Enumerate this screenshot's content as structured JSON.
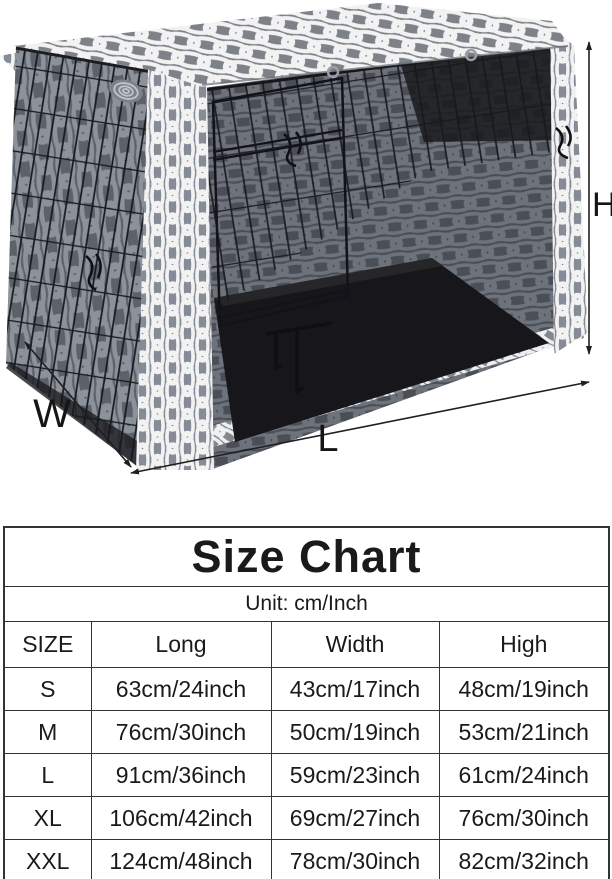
{
  "figure": {
    "dimension_labels": {
      "height": "H",
      "width": "W",
      "length": "L"
    },
    "colors": {
      "cover_gray": "#7d8289",
      "pattern_white": "#f2f2f3",
      "wire_black": "#1a1b1e",
      "interior_black": "#17161a",
      "arrow_black": "#1f1f1f"
    }
  },
  "size_chart": {
    "title": "Size Chart",
    "unit_label": "Unit: cm/Inch",
    "columns": [
      "SIZE",
      "Long",
      "Width",
      "High"
    ],
    "rows": [
      {
        "size": "S",
        "long": "63cm/24inch",
        "width": "43cm/17inch",
        "high": "48cm/19inch"
      },
      {
        "size": "M",
        "long": "76cm/30inch",
        "width": "50cm/19inch",
        "high": "53cm/21inch"
      },
      {
        "size": "L",
        "long": "91cm/36inch",
        "width": "59cm/23inch",
        "high": "61cm/24inch"
      },
      {
        "size": "XL",
        "long": "106cm/42inch",
        "width": "69cm/27inch",
        "high": "76cm/30inch"
      },
      {
        "size": "XXL",
        "long": "124cm/48inch",
        "width": "78cm/30inch",
        "high": "82cm/32inch"
      }
    ]
  },
  "chart_data": {
    "type": "table",
    "title": "Size Chart",
    "subtitle": "Unit: cm/Inch",
    "columns": [
      "SIZE",
      "Long",
      "Width",
      "High"
    ],
    "rows": [
      [
        "S",
        "63cm/24inch",
        "43cm/17inch",
        "48cm/19inch"
      ],
      [
        "M",
        "76cm/30inch",
        "50cm/19inch",
        "53cm/21inch"
      ],
      [
        "L",
        "91cm/36inch",
        "59cm/23inch",
        "61cm/24inch"
      ],
      [
        "XL",
        "106cm/42inch",
        "69cm/27inch",
        "76cm/30inch"
      ],
      [
        "XXL",
        "124cm/48inch",
        "78cm/30inch",
        "82cm/32inch"
      ]
    ],
    "annotations": [
      "H",
      "W",
      "L"
    ]
  }
}
